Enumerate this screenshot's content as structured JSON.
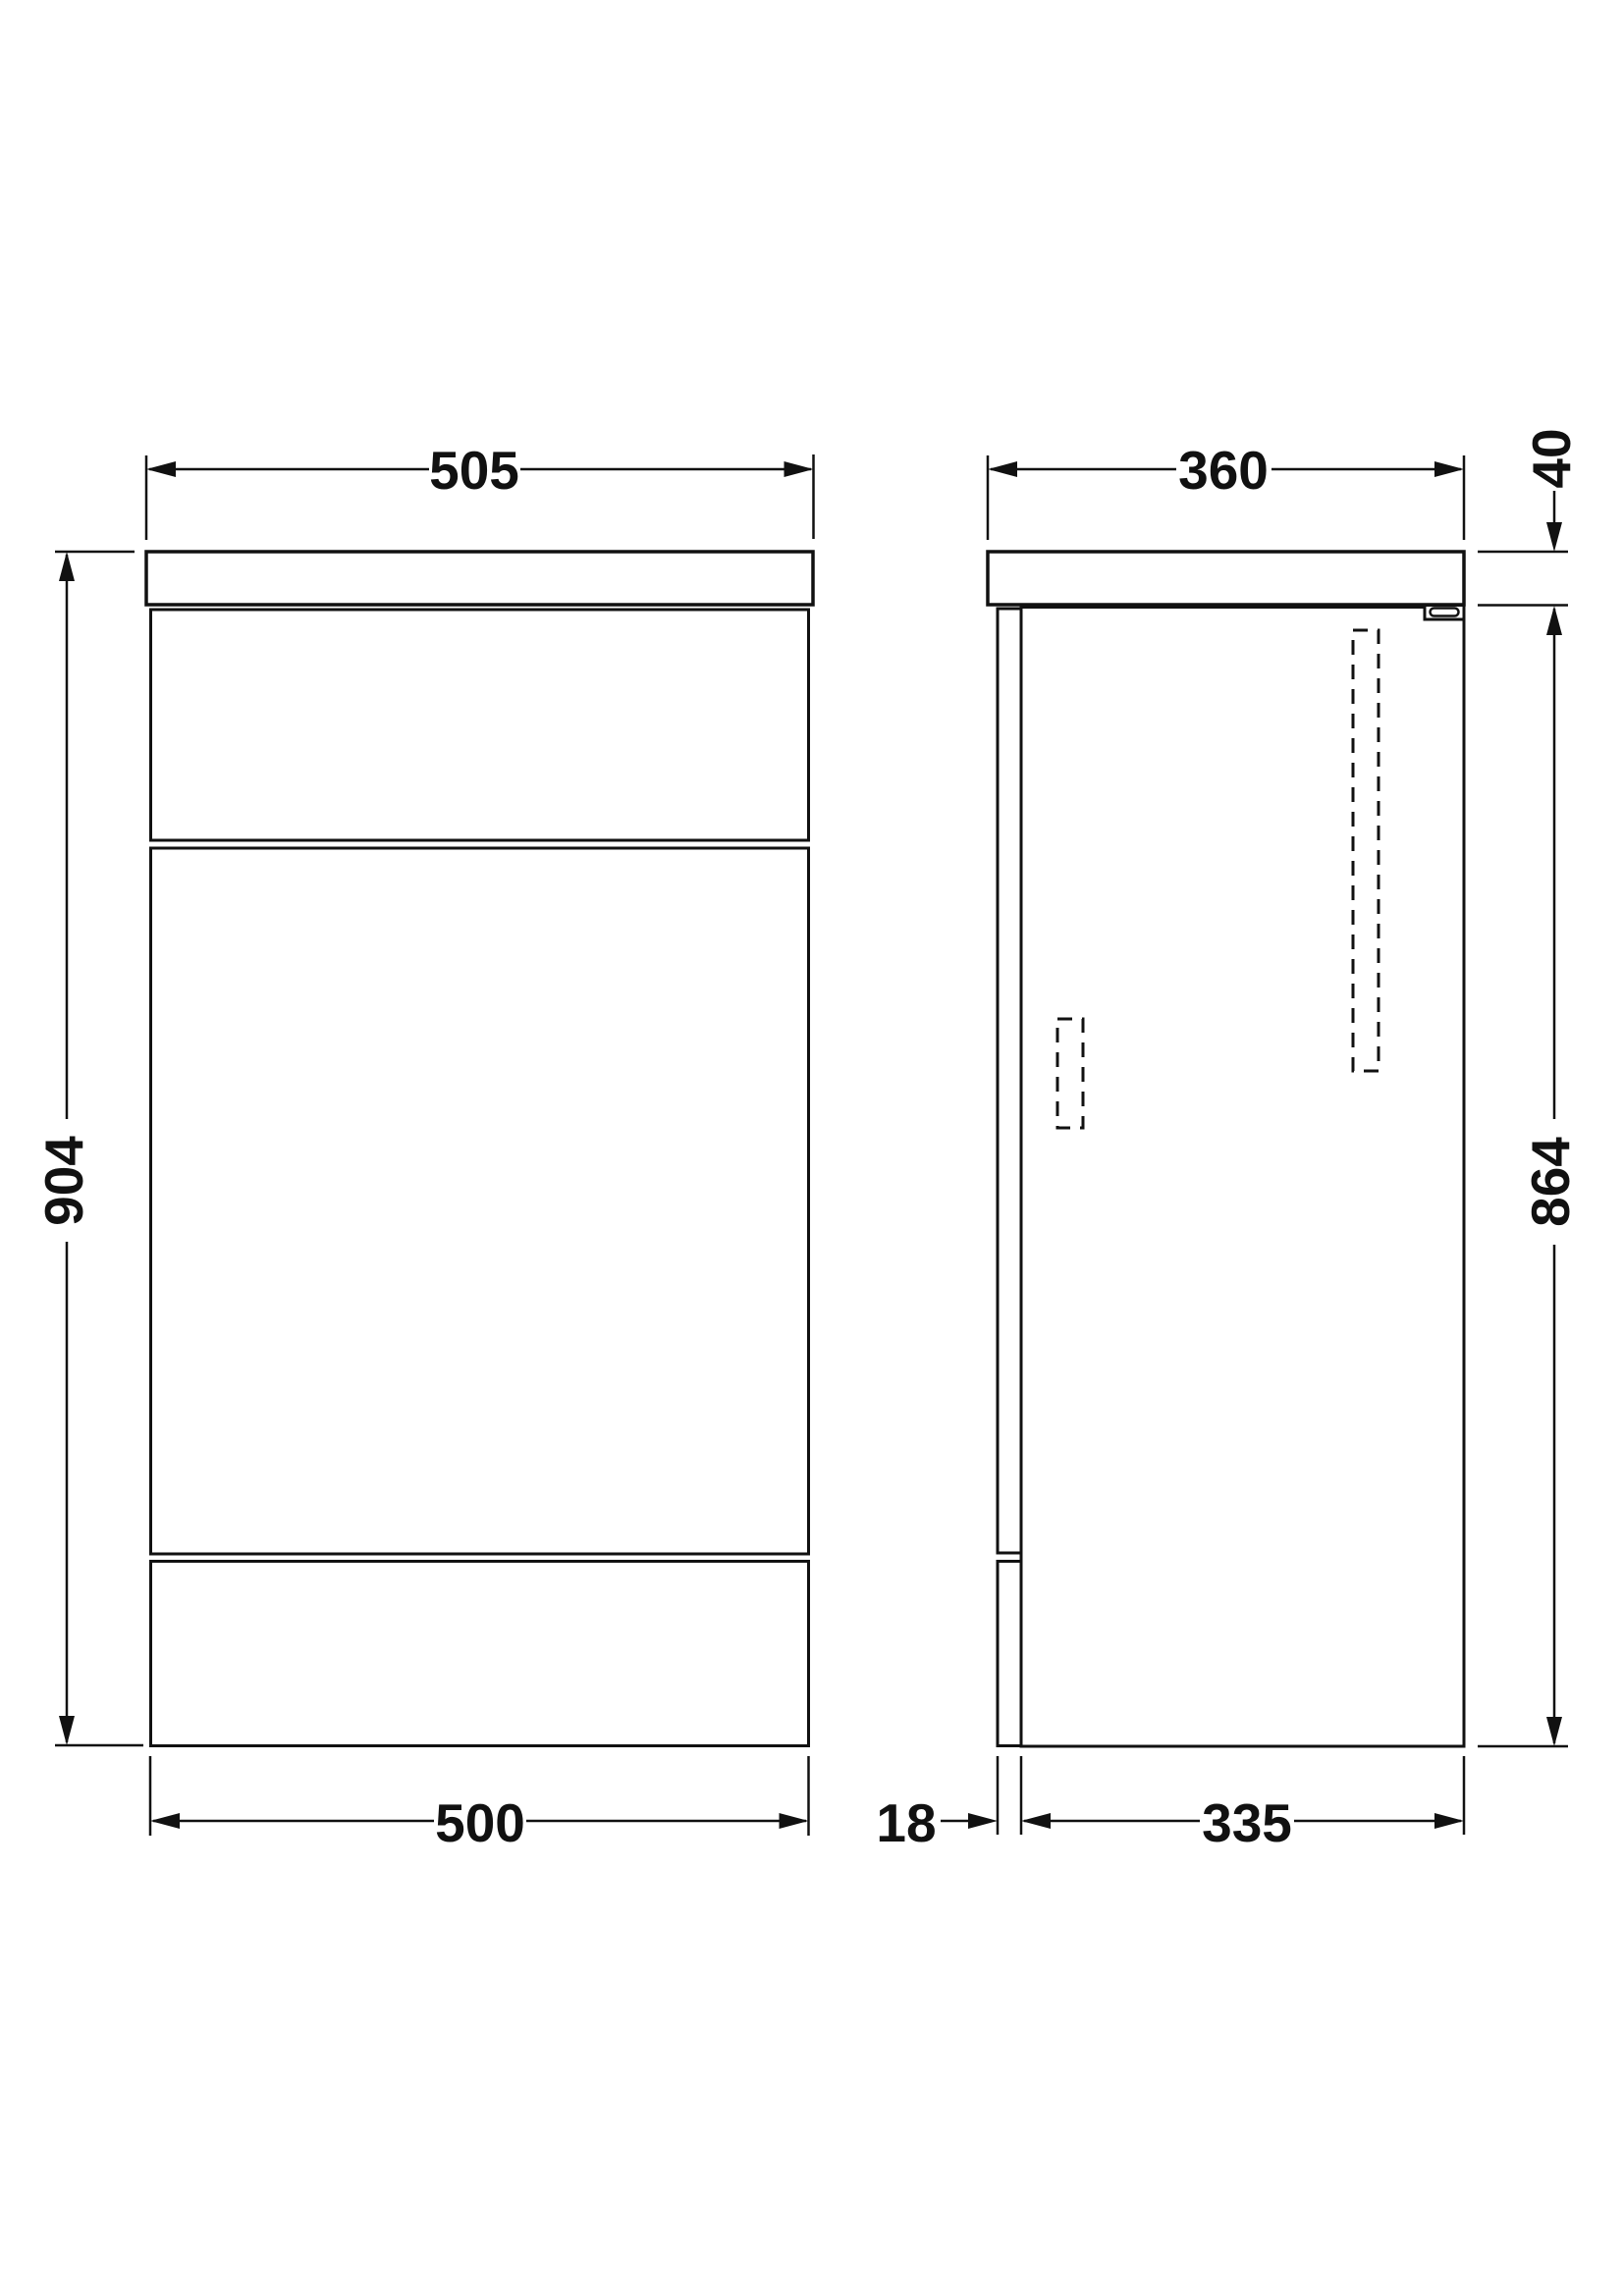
{
  "drawing": {
    "background_color": "#ffffff",
    "line_color": "#111111",
    "dimensions": {
      "front_width_top": "505",
      "front_height_overall": "904",
      "front_width_bottom": "500",
      "side_depth_top": "360",
      "side_worktop_thickness": "40",
      "side_height_cabinet": "864",
      "side_back_panel": "18",
      "side_depth_cabinet": "335"
    }
  }
}
